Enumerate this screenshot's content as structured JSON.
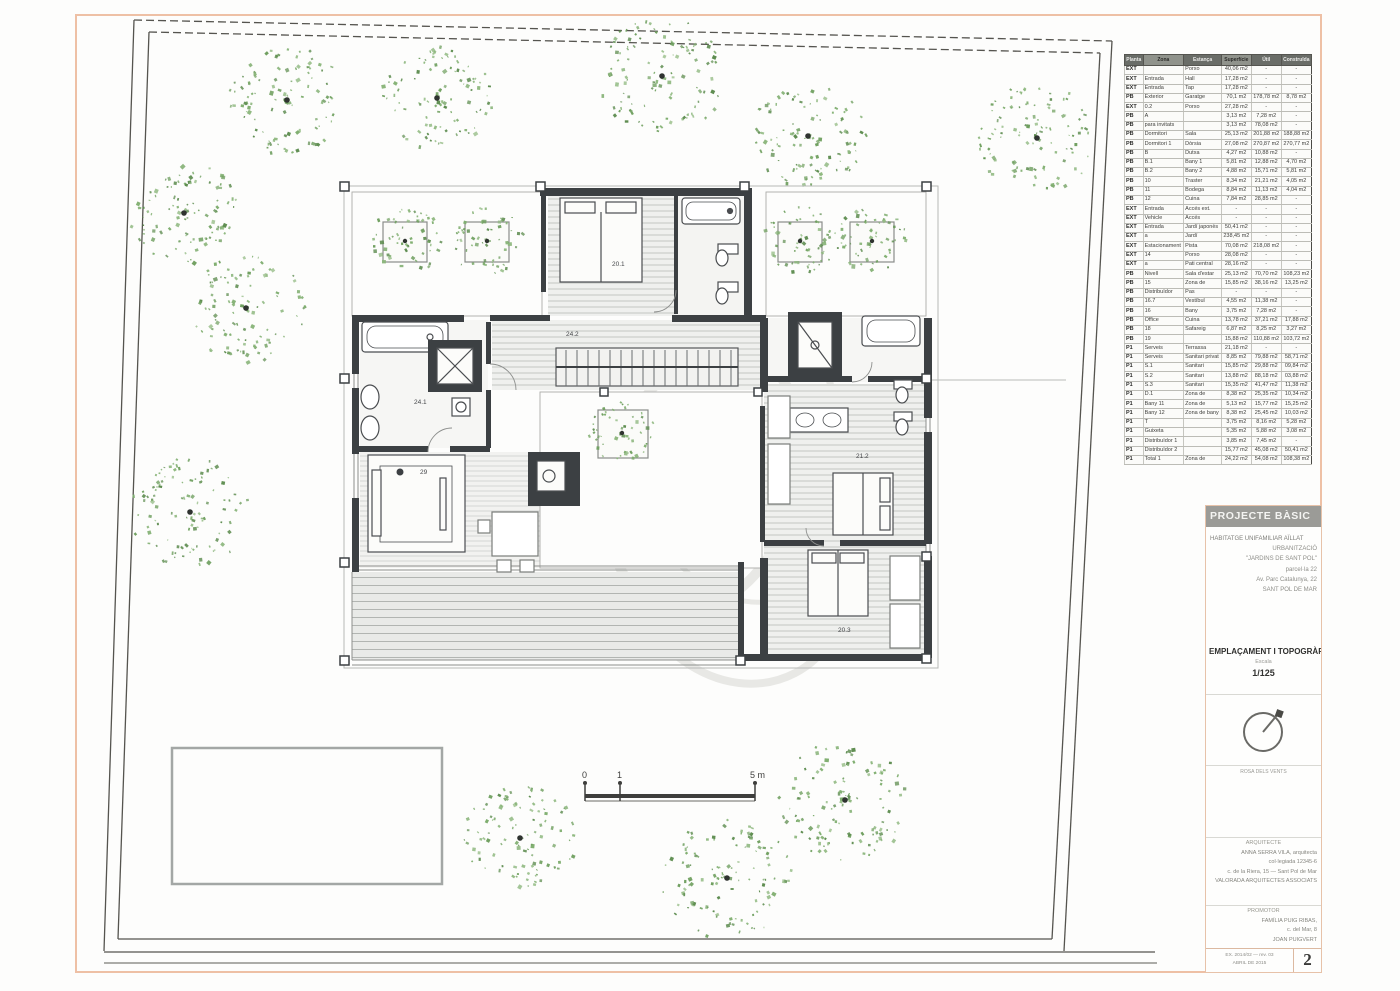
{
  "colors": {
    "page_border": "#eec0a5",
    "site_line": "#55544f",
    "wall_dark": "#3c4043",
    "tree_green": "#6f9f5f",
    "hatch_gray": "#c3c6c3"
  },
  "schedule": {
    "headers": [
      "Planta",
      "Zona",
      "Estança",
      "Superfície",
      "Útil",
      "Construïda"
    ],
    "rows": [
      [
        "EXT",
        "",
        "Porxo",
        "40,06 m2",
        "-",
        "-"
      ],
      [
        "EXT",
        "Entrada",
        "Hall",
        "17,28 m2",
        "-",
        "-"
      ],
      [
        "EXT",
        "Entrada",
        "Tap",
        "17,28 m2",
        "-",
        "-"
      ],
      [
        "PB",
        "Exterior",
        "Garatge",
        "70,1 m2",
        "178,78 m2",
        "8,78 m2"
      ],
      [
        "EXT",
        "0.2",
        "Porxo",
        "27,28 m2",
        "-",
        "-"
      ],
      [
        "PB",
        "A",
        "",
        "3,13 m2",
        "7,28 m2",
        "-"
      ],
      [
        "PB",
        "para invitats",
        "",
        "3,13 m2",
        "78,08 m2",
        "-"
      ],
      [
        "PB",
        "Dormitori",
        "Sala",
        "25,13 m2",
        "201,88 m2",
        "188,88 m2"
      ],
      [
        "PB",
        "Dormitori 1",
        "Dòrsia",
        "27,08 m2",
        "270,87 m2",
        "270,77 m2"
      ],
      [
        "PB",
        "B",
        "Dutxa",
        "4,27 m2",
        "10,88 m2",
        "-"
      ],
      [
        "PB",
        "B.1",
        "Bany 1",
        "5,81 m2",
        "12,88 m2",
        "4,70 m2"
      ],
      [
        "PB",
        "B.2",
        "Bany 2",
        "4,88 m2",
        "15,71 m2",
        "5,81 m2"
      ],
      [
        "PB",
        "10",
        "Traster",
        "8,34 m2",
        "21,21 m2",
        "4,05 m2"
      ],
      [
        "PB",
        "11",
        "Bodega",
        "8,84 m2",
        "11,13 m2",
        "4,04 m2"
      ],
      [
        "PB",
        "12",
        "Cuina",
        "7,84 m2",
        "28,85 m2",
        "-"
      ],
      [
        "EXT",
        "Entrada",
        "Accés ext.",
        "-",
        "-",
        "-"
      ],
      [
        "EXT",
        "Vehicle",
        "Accés",
        "-",
        "-",
        "-"
      ],
      [
        "EXT",
        "Entrada",
        "Jardí japonès",
        "50,41 m2",
        "-",
        "-"
      ],
      [
        "EXT",
        "a",
        "Jardí",
        "238,45 m2",
        "-",
        "-"
      ],
      [
        "EXT",
        "Estacionament",
        "Pista",
        "70,08 m2",
        "218,08 m2",
        "-"
      ],
      [
        "EXT",
        "14",
        "Porxo",
        "28,08 m2",
        "-",
        "-"
      ],
      [
        "EXT",
        "a",
        "Pati central",
        "28,16 m2",
        "-",
        "-"
      ],
      [
        "PB",
        "Nivell",
        "Sala d'estar",
        "25,13 m2",
        "70,70 m2",
        "108,23 m2"
      ],
      [
        "PB",
        "15",
        "Zona de",
        "15,85 m2",
        "38,16 m2",
        "13,25 m2"
      ],
      [
        "PB",
        "Distribuïdor",
        "Pas",
        "-",
        "-",
        "-"
      ],
      [
        "PB",
        "16.7",
        "Vestíbul",
        "4,55 m2",
        "11,38 m2",
        "-"
      ],
      [
        "PB",
        "16",
        "Bany",
        "3,75 m2",
        "7,28 m2",
        "-"
      ],
      [
        "PB",
        "Office",
        "Cuina",
        "13,78 m2",
        "37,21 m2",
        "17,88 m2"
      ],
      [
        "PB",
        "18",
        "Safareig",
        "6,87 m2",
        "8,25 m2",
        "3,27 m2"
      ],
      [
        "PB",
        "19",
        "",
        "15,88 m2",
        "110,88 m2",
        "103,72 m2"
      ],
      [
        "P1",
        "Serveis",
        "Terrassa",
        "21,18 m2",
        "-",
        "-"
      ],
      [
        "P1",
        "Serveis",
        "Sanitari privat",
        "8,85 m2",
        "79,88 m2",
        "58,71 m2"
      ],
      [
        "P1",
        "S.1",
        "Sanitari",
        "15,85 m2",
        "29,88 m2",
        "09,84 m2"
      ],
      [
        "P1",
        "S.2",
        "Sanitari",
        "13,88 m2",
        "88,18 m2",
        "03,88 m2"
      ],
      [
        "P1",
        "S.3",
        "Sanitari",
        "15,35 m2",
        "41,47 m2",
        "11,38 m2"
      ],
      [
        "P1",
        "D.1",
        "Zona de",
        "8,38 m2",
        "25,35 m2",
        "10,34 m2"
      ],
      [
        "P1",
        "Bany 11",
        "Zona de",
        "5,13 m2",
        "15,77 m2",
        "15,25 m2"
      ],
      [
        "P1",
        "Bany 12",
        "Zona de bany",
        "8,38 m2",
        "25,45 m2",
        "10,03 m2"
      ],
      [
        "P1",
        "T",
        "",
        "3,75 m2",
        "8,16 m2",
        "5,28 m2"
      ],
      [
        "P1",
        "Guixeta",
        "",
        "5,35 m2",
        "5,88 m2",
        "3,08 m2"
      ],
      [
        "P1",
        "Distribuïdor 1",
        "",
        "3,85 m2",
        "7,45 m2",
        "-"
      ],
      [
        "P1",
        "Distribuïdor 2",
        "",
        "15,77 m2",
        "45,08 m2",
        "50,41 m2"
      ],
      [
        "P1",
        "Total 1",
        "Zona de",
        "24,22 m2",
        "54,08 m2",
        "108,38 m2"
      ]
    ]
  },
  "title_block": {
    "header": "PROJECTE BÀSIC",
    "project_lines": [
      "HABITATGE UNIFAMILIAR AÏLLAT",
      "URBANITZACIÓ",
      "\"JARDINS DE SANT POL\"",
      "parcel·la 22",
      "Av. Parc Catalunya, 22",
      "SANT POL DE MAR"
    ],
    "drawing_title": "EMPLAÇAMENT I TOPOGRÀFIC",
    "scale_label": "Escala",
    "scale_value": "1/125",
    "north_caption": "ROSA DELS VENTS",
    "architect_label": "ARQUITECTE",
    "architect_lines": [
      "ANNA SERRA VILA, arquitecta",
      "col·legiada 12345-6",
      "c. de la Riera, 15 — Sant Pol de Mar",
      "VALORADA ARQUITECTES ASSOCIATS"
    ],
    "promoter_label": "PROMOTOR",
    "promoter_lines": [
      "FAMÍLIA PUIG RIBAS,",
      "c. del Mar, 8",
      "JOAN PUIGVERT"
    ],
    "footer_lines": [
      "EX. 2014/02 — rev. 03",
      "ABRIL DE 2015"
    ],
    "sheet_number": "2"
  },
  "scalebar": {
    "ticks": [
      "0",
      "1",
      "5 m"
    ]
  },
  "plan": {
    "labels": [
      {
        "text": "20.1",
        "x": 612,
        "y": 266
      },
      {
        "text": "24.2",
        "x": 566,
        "y": 336
      },
      {
        "text": "24.1",
        "x": 414,
        "y": 404
      },
      {
        "text": "29",
        "x": 420,
        "y": 474
      },
      {
        "text": "21.2",
        "x": 856,
        "y": 458
      },
      {
        "text": "20.3",
        "x": 838,
        "y": 632
      }
    ],
    "planter_trees": [
      {
        "x": 405,
        "y": 241,
        "r": 36
      },
      {
        "x": 487,
        "y": 241,
        "r": 36
      },
      {
        "x": 800,
        "y": 241,
        "r": 36
      },
      {
        "x": 872,
        "y": 241,
        "r": 36
      },
      {
        "x": 622,
        "y": 433,
        "r": 33
      }
    ]
  },
  "site": {
    "trees": [
      {
        "x": 287,
        "y": 100,
        "r": 58
      },
      {
        "x": 437,
        "y": 98,
        "r": 54
      },
      {
        "x": 662,
        "y": 76,
        "r": 62
      },
      {
        "x": 808,
        "y": 136,
        "r": 56
      },
      {
        "x": 1037,
        "y": 138,
        "r": 58
      },
      {
        "x": 184,
        "y": 213,
        "r": 54
      },
      {
        "x": 246,
        "y": 308,
        "r": 57
      },
      {
        "x": 190,
        "y": 512,
        "r": 58
      },
      {
        "x": 845,
        "y": 800,
        "r": 64
      },
      {
        "x": 520,
        "y": 838,
        "r": 56
      },
      {
        "x": 727,
        "y": 878,
        "r": 64
      }
    ]
  }
}
